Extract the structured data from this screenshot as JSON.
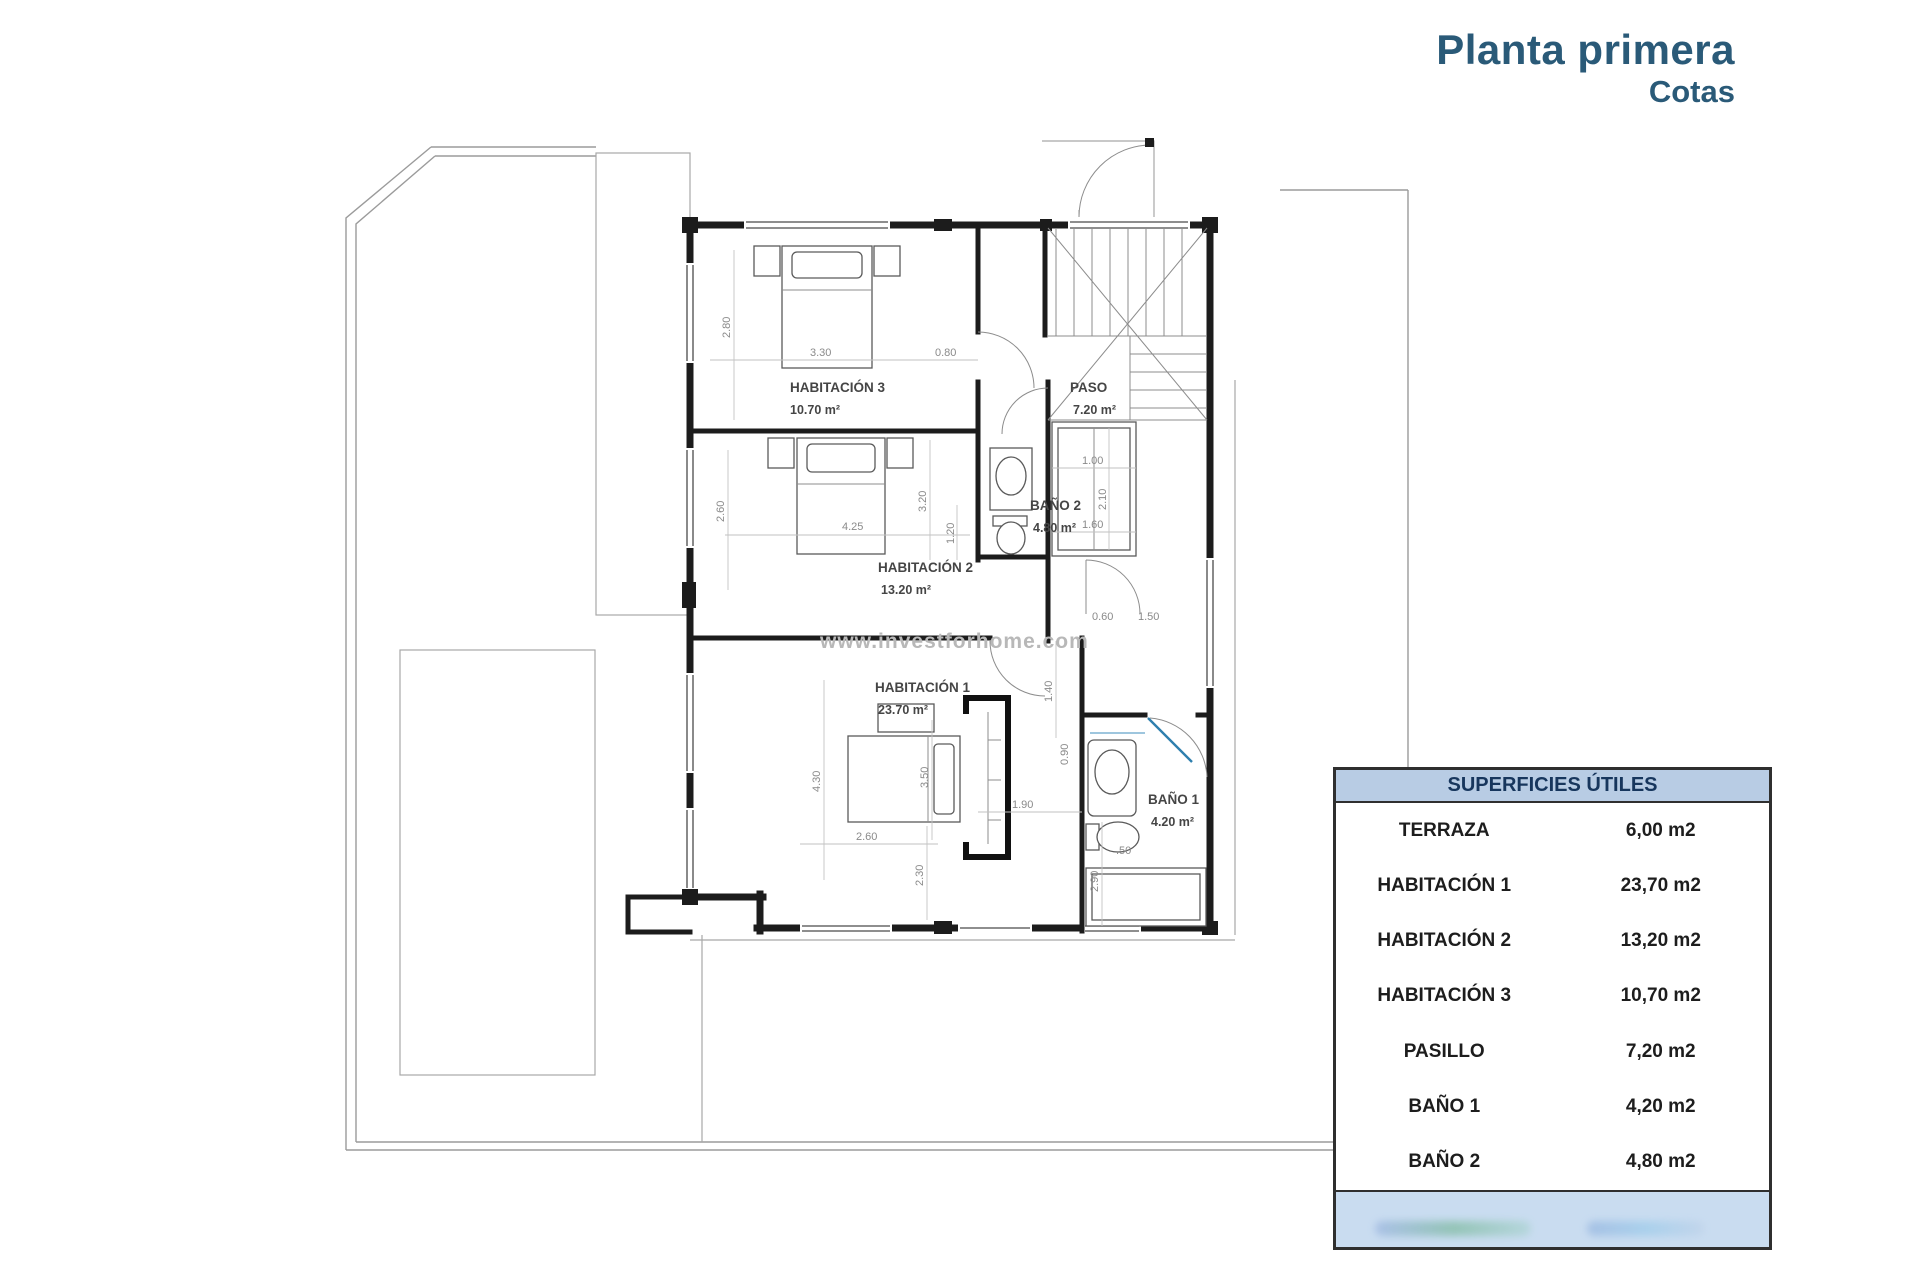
{
  "title": {
    "main": "Planta primera",
    "sub": "Cotas"
  },
  "watermark": "www.investforhome.com",
  "table": {
    "header": "SUPERFICIES ÚTILES",
    "rows": [
      {
        "label": "TERRAZA",
        "value": "6,00 m2"
      },
      {
        "label": "HABITACIÓN 1",
        "value": "23,70 m2"
      },
      {
        "label": "HABITACIÓN 2",
        "value": "13,20 m2"
      },
      {
        "label": "HABITACIÓN 3",
        "value": "10,70 m2"
      },
      {
        "label": "PASILLO",
        "value": "7,20 m2"
      },
      {
        "label": "BAÑO 1",
        "value": "4,20 m2"
      },
      {
        "label": "BAÑO 2",
        "value": "4,80 m2"
      }
    ]
  },
  "plan": {
    "rooms": {
      "hab3": {
        "name": "HABITACIÓN 3",
        "area": "10.70 m²"
      },
      "paso": {
        "name": "PASO",
        "area": "7.20 m²"
      },
      "bano2": {
        "name": "BAÑO 2",
        "area": "4.80 m²"
      },
      "hab2": {
        "name": "HABITACIÓN 2",
        "area": "13.20 m²"
      },
      "hab1": {
        "name": "HABITACIÓN 1",
        "area": "23.70 m²"
      },
      "bano1": {
        "name": "BAÑO 1",
        "area": "4.20 m²"
      }
    },
    "dims": {
      "hab3_h": "2.80",
      "hab3_w": "3.30",
      "hab3_d": "0.80",
      "hab2_h": "2.60",
      "hab2_w": "4.25",
      "hab2_e": "3.20",
      "bano2_w": "1.20",
      "closet_w": "1.00",
      "closet_h": "2.10",
      "closet_w2": "1.60",
      "hall_a": "0.60",
      "hall_b": "1.50",
      "hab1_a": "1.40",
      "hab1_b": "0.90",
      "hab1_c": "1.90",
      "hab1_d": "3.50",
      "hab1_e": "4.30",
      "hab1_f": "2.60",
      "hab1_g": "2.30",
      "bano1_a": "2.90",
      "bano1_b": ".50"
    }
  },
  "colors": {
    "accent": "#2a5a78",
    "table_header_bg": "#b8cce4",
    "table_footer_bg": "#c9dcf0",
    "table_header_text": "#17365d"
  }
}
